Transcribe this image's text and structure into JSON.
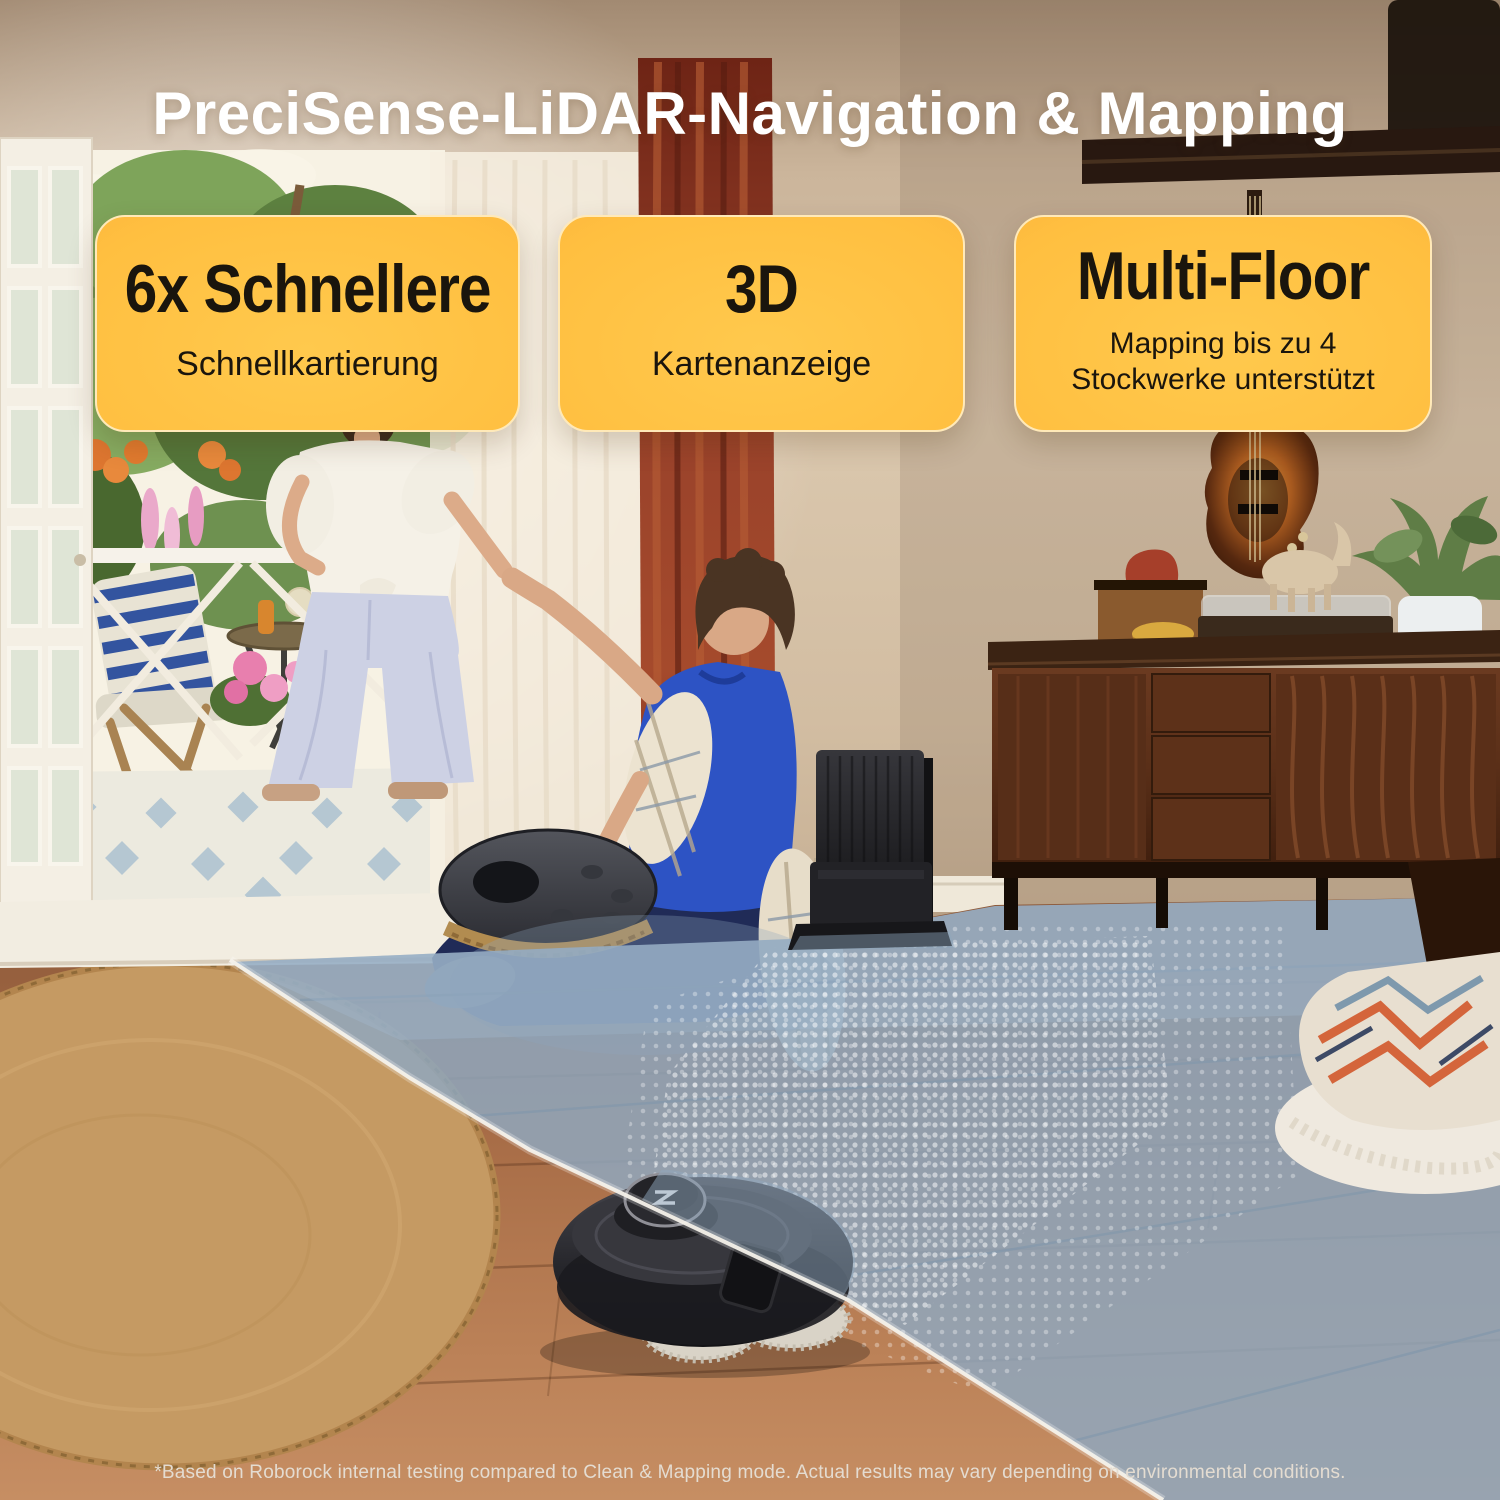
{
  "title": "PreciSense-LiDAR-Navigation & Mapping",
  "cards": [
    {
      "heading": "6x Schnellere",
      "subheading": "Schnellkartierung"
    },
    {
      "heading": "3D",
      "subheading": "Kartenanzeige"
    },
    {
      "heading": "Multi-Floor",
      "subheading": "Mapping bis zu 4 Stockwerke unterstützt"
    }
  ],
  "footer": {
    "disclaimer": "*Based on Roborock internal testing compared to Clean & Mapping mode.  Actual results may vary depending on environmental conditions."
  },
  "colors": {
    "title_text": "#ffffff",
    "card_text": "#1a150d",
    "card_gradient_center": "#ffc94d",
    "card_gradient_edge": "#f79f33",
    "card_border": "#ffe9b8",
    "lidar_beam": "#8fa7bd",
    "beam_edge_line": "#f4f1ea",
    "wood_floor": "#a96c48",
    "wall": "#d2bda2",
    "polo_blue": "#2d53c4"
  },
  "scene": {
    "objects": [
      "french-door",
      "balcony-garden",
      "garden-chair",
      "bistro-table",
      "standing-woman",
      "sheer-curtain",
      "red-curtain",
      "sitting-man",
      "handpan-drum",
      "dock-station",
      "baseboard",
      "wall-shelf",
      "tv-corner",
      "bass-guitar",
      "sideboard",
      "wooden-box",
      "snack-bowl",
      "record-player",
      "horse-figurine",
      "potted-plant",
      "wood-floor",
      "round-rug",
      "lidar-beam",
      "halftone-dots",
      "blanket-pile",
      "robot-vacuum",
      "roborock-logo",
      "beam-edge-line"
    ]
  }
}
